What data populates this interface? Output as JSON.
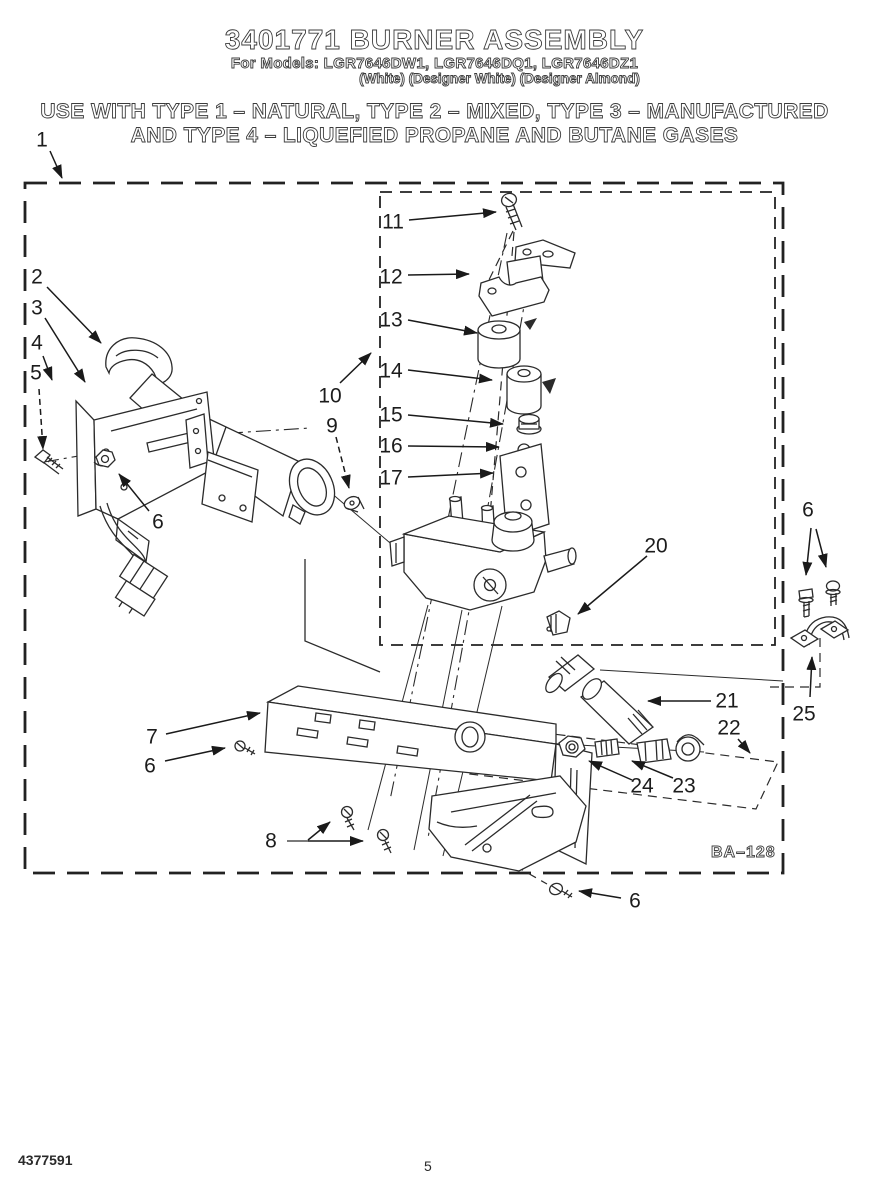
{
  "header": {
    "title": "3401771 BURNER ASSEMBLY",
    "models_line": "For Models: LGR7646DW1, LGR7646DQ1, LGR7646DZ1",
    "finishes_line": "(White) (Designer White) (Designer Almond)",
    "usage_line_1": "USE WITH TYPE 1 – NATURAL, TYPE 2 – MIXED, TYPE 3 – MANUFACTURED",
    "usage_line_2": "AND TYPE 4 – LIQUEFIED PROPANE AND BUTANE GASES"
  },
  "diagram": {
    "reference_code": "BA–128",
    "callouts": [
      {
        "label": "1"
      },
      {
        "label": "2"
      },
      {
        "label": "3"
      },
      {
        "label": "4"
      },
      {
        "label": "5"
      },
      {
        "label": "6"
      },
      {
        "label": "7"
      },
      {
        "label": "6"
      },
      {
        "label": "8"
      },
      {
        "label": "9"
      },
      {
        "label": "10"
      },
      {
        "label": "11"
      },
      {
        "label": "12"
      },
      {
        "label": "13"
      },
      {
        "label": "14"
      },
      {
        "label": "15"
      },
      {
        "label": "16"
      },
      {
        "label": "17"
      },
      {
        "label": "20"
      },
      {
        "label": "21"
      },
      {
        "label": "22"
      },
      {
        "label": "23"
      },
      {
        "label": "24"
      },
      {
        "label": "25"
      },
      {
        "label": "6"
      },
      {
        "label": "6"
      }
    ]
  },
  "footer": {
    "document_number": "4377591",
    "page_number": "5"
  }
}
